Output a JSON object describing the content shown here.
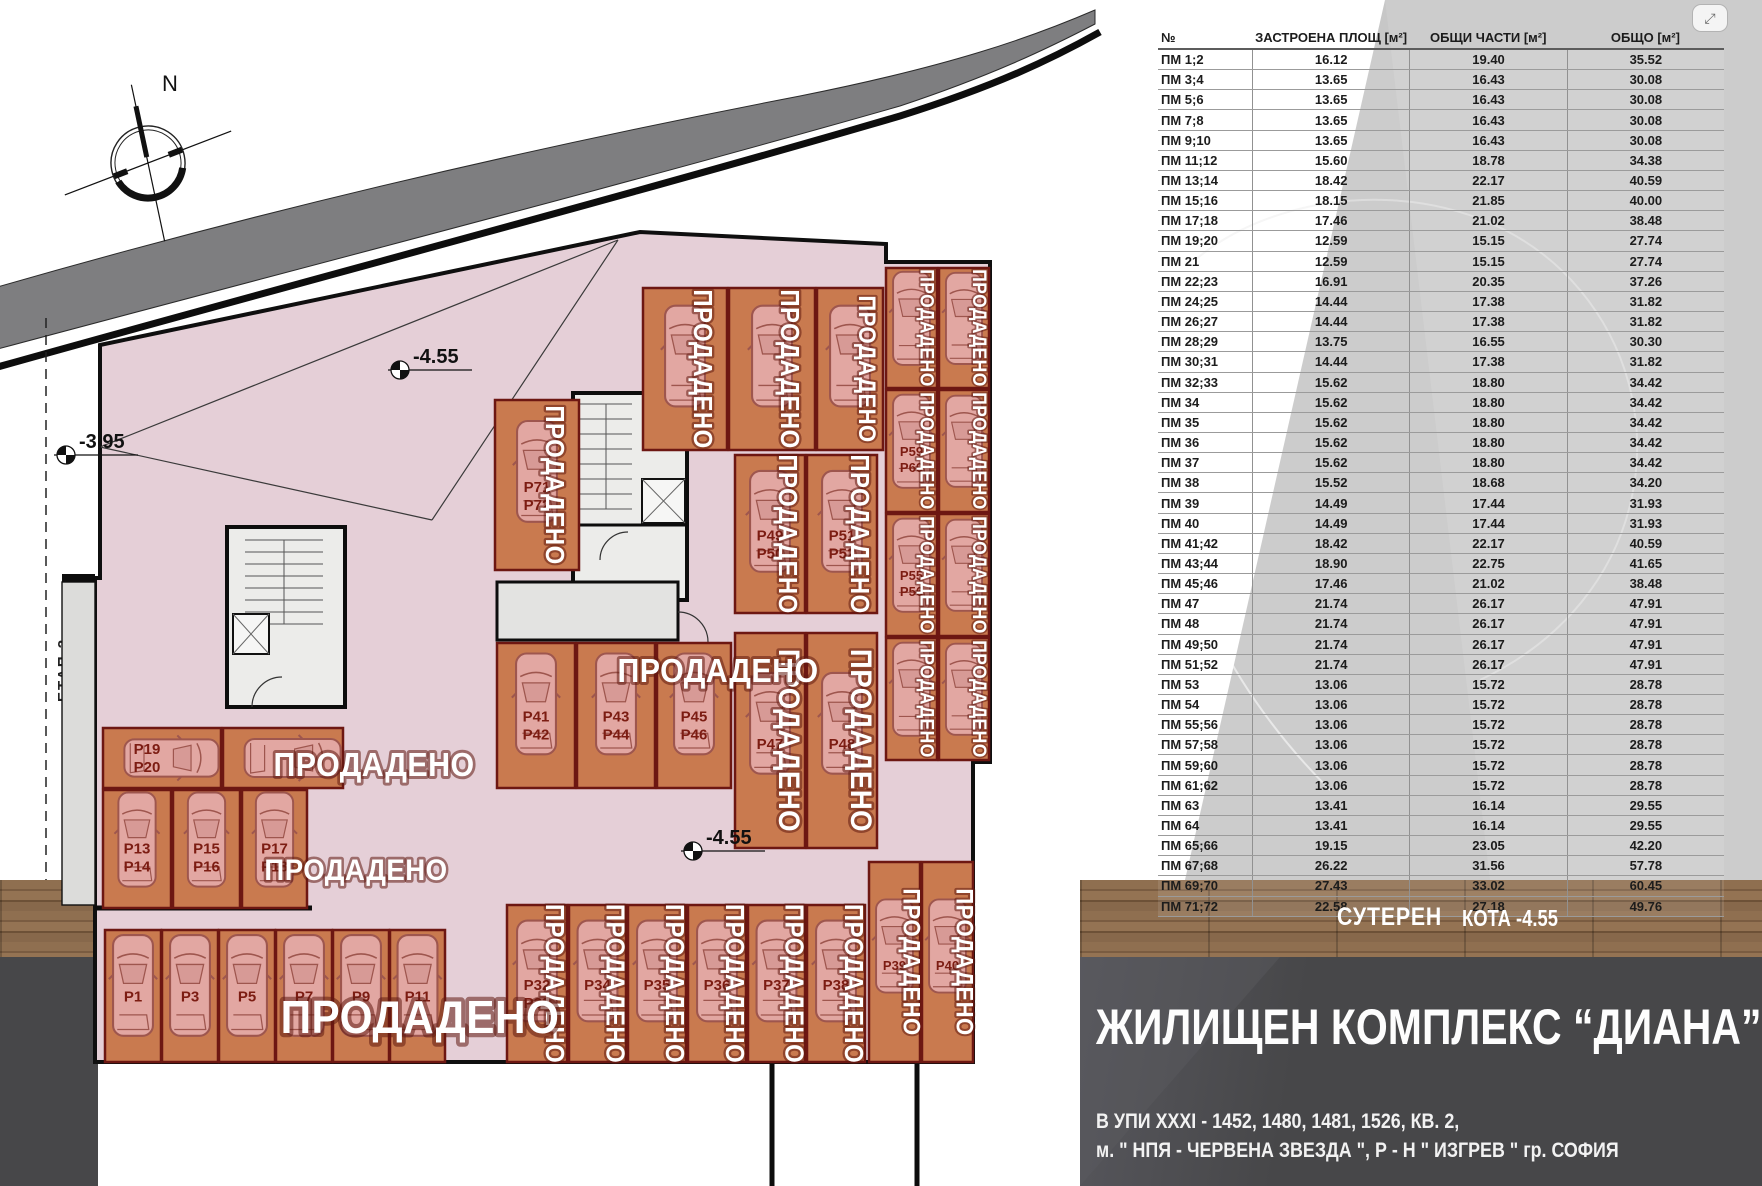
{
  "viewer": {
    "expand_icon": "⤢"
  },
  "table": {
    "headers": [
      "№",
      "ЗАСТРОЕНА ПЛОЩ [м²]",
      "ОБЩИ ЧАСТИ [м²]",
      "ОБЩО [м²]"
    ],
    "rows": [
      [
        "ПМ 1;2",
        "16.12",
        "19.40",
        "35.52"
      ],
      [
        "ПМ 3;4",
        "13.65",
        "16.43",
        "30.08"
      ],
      [
        "ПМ 5;6",
        "13.65",
        "16.43",
        "30.08"
      ],
      [
        "ПМ 7;8",
        "13.65",
        "16.43",
        "30.08"
      ],
      [
        "ПМ 9;10",
        "13.65",
        "16.43",
        "30.08"
      ],
      [
        "ПМ 11;12",
        "15.60",
        "18.78",
        "34.38"
      ],
      [
        "ПМ 13;14",
        "18.42",
        "22.17",
        "40.59"
      ],
      [
        "ПМ 15;16",
        "18.15",
        "21.85",
        "40.00"
      ],
      [
        "ПМ 17;18",
        "17.46",
        "21.02",
        "38.48"
      ],
      [
        "ПМ 19;20",
        "12.59",
        "15.15",
        "27.74"
      ],
      [
        "ПМ 21",
        "12.59",
        "15.15",
        "27.74"
      ],
      [
        "ПМ 22;23",
        "16.91",
        "20.35",
        "37.26"
      ],
      [
        "ПМ 24;25",
        "14.44",
        "17.38",
        "31.82"
      ],
      [
        "ПМ 26;27",
        "14.44",
        "17.38",
        "31.82"
      ],
      [
        "ПМ 28;29",
        "13.75",
        "16.55",
        "30.30"
      ],
      [
        "ПМ 30;31",
        "14.44",
        "17.38",
        "31.82"
      ],
      [
        "ПМ 32;33",
        "15.62",
        "18.80",
        "34.42"
      ],
      [
        "ПМ 34",
        "15.62",
        "18.80",
        "34.42"
      ],
      [
        "ПМ 35",
        "15.62",
        "18.80",
        "34.42"
      ],
      [
        "ПМ 36",
        "15.62",
        "18.80",
        "34.42"
      ],
      [
        "ПМ 37",
        "15.62",
        "18.80",
        "34.42"
      ],
      [
        "ПМ 38",
        "15.52",
        "18.68",
        "34.20"
      ],
      [
        "ПМ 39",
        "14.49",
        "17.44",
        "31.93"
      ],
      [
        "ПМ 40",
        "14.49",
        "17.44",
        "31.93"
      ],
      [
        "ПМ 41;42",
        "18.42",
        "22.17",
        "40.59"
      ],
      [
        "ПМ 43;44",
        "18.90",
        "22.75",
        "41.65"
      ],
      [
        "ПМ 45;46",
        "17.46",
        "21.02",
        "38.48"
      ],
      [
        "ПМ 47",
        "21.74",
        "26.17",
        "47.91"
      ],
      [
        "ПМ 48",
        "21.74",
        "26.17",
        "47.91"
      ],
      [
        "ПМ 49;50",
        "21.74",
        "26.17",
        "47.91"
      ],
      [
        "ПМ 51;52",
        "21.74",
        "26.17",
        "47.91"
      ],
      [
        "ПМ 53",
        "13.06",
        "15.72",
        "28.78"
      ],
      [
        "ПМ 54",
        "13.06",
        "15.72",
        "28.78"
      ],
      [
        "ПМ 55;56",
        "13.06",
        "15.72",
        "28.78"
      ],
      [
        "ПМ 57;58",
        "13.06",
        "15.72",
        "28.78"
      ],
      [
        "ПМ 59;60",
        "13.06",
        "15.72",
        "28.78"
      ],
      [
        "ПМ 61;62",
        "13.06",
        "15.72",
        "28.78"
      ],
      [
        "ПМ 63",
        "13.41",
        "16.14",
        "29.55"
      ],
      [
        "ПМ 64",
        "13.41",
        "16.14",
        "29.55"
      ],
      [
        "ПМ 65;66",
        "19.15",
        "23.05",
        "42.20"
      ],
      [
        "ПМ 67;68",
        "26.22",
        "31.56",
        "57.78"
      ],
      [
        "ПМ 69;70",
        "27.43",
        "33.02",
        "60.45"
      ],
      [
        "ПМ 71;72",
        "22.58",
        "27.18",
        "49.76"
      ]
    ]
  },
  "info": {
    "level": "СУТЕРЕН",
    "elevation": "КОТА -4.55",
    "title": "ЖИЛИЩЕН КОМПЛЕКС  “ДИАНА”",
    "address1": "В УПИ XXXI - 1452, 1480, 1481, 1526, КВ. 2,",
    "address2": "м. \" НПЯ - ЧЕРВЕНА ЗВЕЗДА \", Р - Н \" ИЗГРЕВ \"  гр. СОФИЯ"
  },
  "plan": {
    "north_label": "N",
    "stage_label": "ЕТАП 2",
    "sold_label": "ПРОДАДЕНО",
    "elevation_markers": [
      {
        "label": "-3.95",
        "x": 66,
        "y": 455
      },
      {
        "label": "-4.55",
        "x": 400,
        "y": 370
      },
      {
        "label": "-4.55",
        "x": 693,
        "y": 851
      }
    ],
    "sold_banners": [
      {
        "x": 224,
        "y": 776,
        "size": 33
      },
      {
        "x": 206,
        "y": 880,
        "size": 30
      },
      {
        "x": 270,
        "y": 1033,
        "size": 46
      },
      {
        "x": 568,
        "y": 682,
        "size": 33
      }
    ],
    "stalls": [
      {
        "x": 495,
        "y": 400,
        "w": 84,
        "h": 170,
        "o": "v",
        "l1": "P71",
        "l2": "P72",
        "sold": "v",
        "ss": 26
      },
      {
        "x": 643,
        "y": 288,
        "w": 84,
        "h": 162,
        "o": "v",
        "l1": "",
        "l2": "",
        "sold": "v",
        "ss": 26
      },
      {
        "x": 729,
        "y": 288,
        "w": 86,
        "h": 162,
        "o": "v",
        "l1": "",
        "l2": "",
        "sold": "v",
        "ss": 26
      },
      {
        "x": 817,
        "y": 288,
        "w": 66,
        "h": 162,
        "o": "v",
        "l1": "",
        "l2": "",
        "sold": "v",
        "ss": 24
      },
      {
        "x": 886,
        "y": 268,
        "w": 51,
        "h": 120,
        "o": "v",
        "l1": "",
        "l2": "",
        "sold": "v",
        "ss": 19
      },
      {
        "x": 939,
        "y": 268,
        "w": 50,
        "h": 120,
        "o": "v",
        "l1": "",
        "l2": "",
        "sold": "v",
        "ss": 19
      },
      {
        "x": 886,
        "y": 390,
        "w": 51,
        "h": 122,
        "o": "v",
        "l1": "P59",
        "l2": "P60",
        "sold": "v",
        "ss": 19
      },
      {
        "x": 939,
        "y": 390,
        "w": 50,
        "h": 122,
        "o": "v",
        "l1": "",
        "l2": "",
        "sold": "v",
        "ss": 19
      },
      {
        "x": 886,
        "y": 514,
        "w": 51,
        "h": 122,
        "o": "v",
        "l1": "P55",
        "l2": "P56",
        "sold": "v",
        "ss": 19
      },
      {
        "x": 939,
        "y": 514,
        "w": 50,
        "h": 122,
        "o": "v",
        "l1": "",
        "l2": "",
        "sold": "v",
        "ss": 19
      },
      {
        "x": 886,
        "y": 638,
        "w": 51,
        "h": 122,
        "o": "v",
        "l1": "",
        "l2": "",
        "sold": "v",
        "ss": 19
      },
      {
        "x": 939,
        "y": 638,
        "w": 50,
        "h": 122,
        "o": "v",
        "l1": "",
        "l2": "",
        "sold": "v",
        "ss": 19
      },
      {
        "x": 735,
        "y": 455,
        "w": 70,
        "h": 158,
        "o": "v",
        "l1": "P49",
        "l2": "P50",
        "sold": "v",
        "ss": 26
      },
      {
        "x": 807,
        "y": 455,
        "w": 70,
        "h": 158,
        "o": "v",
        "l1": "P51",
        "l2": "P52",
        "sold": "v",
        "ss": 26
      },
      {
        "x": 735,
        "y": 633,
        "w": 70,
        "h": 215,
        "o": "v",
        "l1": "P47",
        "l2": "",
        "sold": "v",
        "ss": 30
      },
      {
        "x": 807,
        "y": 633,
        "w": 70,
        "h": 215,
        "o": "v",
        "l1": "P48",
        "l2": "",
        "sold": "v",
        "ss": 30
      },
      {
        "x": 497,
        "y": 643,
        "w": 78,
        "h": 145,
        "o": "v",
        "l1": "P41",
        "l2": "P42",
        "sold": ""
      },
      {
        "x": 577,
        "y": 643,
        "w": 78,
        "h": 145,
        "o": "v",
        "l1": "P43",
        "l2": "P44",
        "sold": ""
      },
      {
        "x": 657,
        "y": 643,
        "w": 74,
        "h": 145,
        "o": "v",
        "l1": "P45",
        "l2": "P46",
        "sold": ""
      },
      {
        "x": 103,
        "y": 728,
        "w": 118,
        "h": 60,
        "o": "h",
        "l1": "P19",
        "l2": "P20",
        "sold": ""
      },
      {
        "x": 223,
        "y": 728,
        "w": 120,
        "h": 60,
        "o": "h",
        "l1": "",
        "l2": "",
        "sold": ""
      },
      {
        "x": 103,
        "y": 790,
        "w": 68,
        "h": 118,
        "o": "v",
        "l1": "P13",
        "l2": "P14",
        "sold": ""
      },
      {
        "x": 173,
        "y": 790,
        "w": 67,
        "h": 118,
        "o": "v",
        "l1": "P15",
        "l2": "P16",
        "sold": ""
      },
      {
        "x": 242,
        "y": 790,
        "w": 65,
        "h": 118,
        "o": "v",
        "l1": "P17",
        "l2": "P18",
        "sold": ""
      },
      {
        "x": 105,
        "y": 930,
        "w": 56,
        "h": 132,
        "o": "v",
        "l1": "P1",
        "l2": "",
        "sold": ""
      },
      {
        "x": 162,
        "y": 930,
        "w": 56,
        "h": 132,
        "o": "v",
        "l1": "P3",
        "l2": "",
        "sold": ""
      },
      {
        "x": 219,
        "y": 930,
        "w": 56,
        "h": 132,
        "o": "v",
        "l1": "P5",
        "l2": "",
        "sold": ""
      },
      {
        "x": 276,
        "y": 930,
        "w": 56,
        "h": 132,
        "o": "v",
        "l1": "P7",
        "l2": "",
        "sold": ""
      },
      {
        "x": 333,
        "y": 930,
        "w": 56,
        "h": 132,
        "o": "v",
        "l1": "P9",
        "l2": "",
        "sold": ""
      },
      {
        "x": 390,
        "y": 930,
        "w": 55,
        "h": 132,
        "o": "v",
        "l1": "P11",
        "l2": "",
        "sold": ""
      },
      {
        "x": 507,
        "y": 905,
        "w": 60,
        "h": 157,
        "o": "v",
        "l1": "P32",
        "l2": "P33",
        "sold": "v",
        "ss": 26
      },
      {
        "x": 569,
        "y": 905,
        "w": 57,
        "h": 157,
        "o": "v",
        "l1": "P34",
        "l2": "",
        "sold": "v",
        "ss": 26
      },
      {
        "x": 628,
        "y": 905,
        "w": 58,
        "h": 157,
        "o": "v",
        "l1": "P35",
        "l2": "",
        "sold": "v",
        "ss": 26
      },
      {
        "x": 688,
        "y": 905,
        "w": 58,
        "h": 157,
        "o": "v",
        "l1": "P36",
        "l2": "",
        "sold": "v",
        "ss": 26
      },
      {
        "x": 748,
        "y": 905,
        "w": 57,
        "h": 157,
        "o": "v",
        "l1": "P37",
        "l2": "",
        "sold": "v",
        "ss": 26
      },
      {
        "x": 807,
        "y": 905,
        "w": 58,
        "h": 157,
        "o": "v",
        "l1": "P38",
        "l2": "",
        "sold": "v",
        "ss": 26
      },
      {
        "x": 869,
        "y": 862,
        "w": 51,
        "h": 200,
        "o": "v",
        "l1": "P39",
        "l2": "",
        "sold": "v",
        "ss": 24
      },
      {
        "x": 922,
        "y": 862,
        "w": 51,
        "h": 200,
        "o": "v",
        "l1": "P40",
        "l2": "",
        "sold": "v",
        "ss": 24
      }
    ]
  },
  "colors": {
    "stall_orange": "#c97a4f",
    "stall_border": "#6d1712",
    "slab_pink": "#e5cfd7",
    "road_gray": "#7e7e80",
    "panel_gray": "#c7c7c7",
    "wood_brown": "#8a6a4b",
    "dark_panel": "#474749",
    "sold_white": "#ffffff",
    "label_red": "#7c1c12"
  }
}
